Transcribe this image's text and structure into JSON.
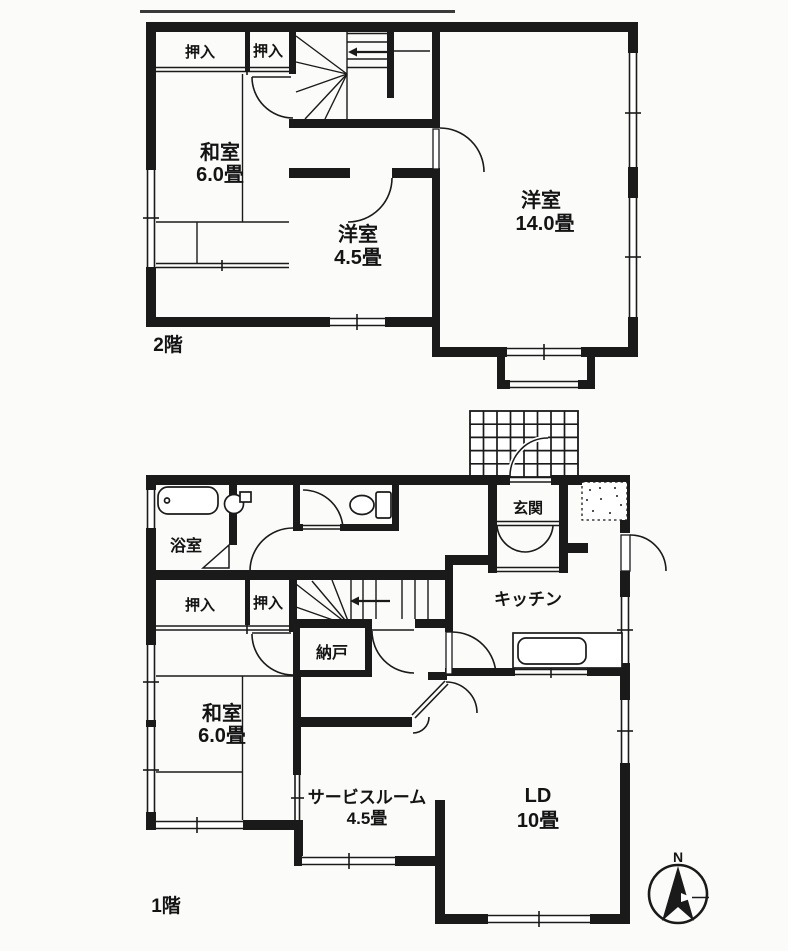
{
  "floor2": {
    "floor_label": "2階",
    "closet1": "押入",
    "closet2": "押入",
    "washitsu": {
      "name": "和室",
      "size": "6.0畳"
    },
    "yoshitsu_small": {
      "name": "洋室",
      "size": "4.5畳"
    },
    "yoshitsu_large": {
      "name": "洋室",
      "size": "14.0畳"
    }
  },
  "floor1": {
    "floor_label": "1階",
    "bath": "浴室",
    "closet1": "押入",
    "closet2": "押入",
    "washitsu": {
      "name": "和室",
      "size": "6.0畳"
    },
    "nando": "納戸",
    "genkan": "玄関",
    "kitchen": "キッチン",
    "service": {
      "name": "サービスルーム",
      "size": "4.5畳"
    },
    "ld": {
      "name": "LD",
      "size": "10畳"
    }
  },
  "compass": {
    "north": "N"
  },
  "colors": {
    "line": "#1a1a1a",
    "background": "#fbfbf9"
  }
}
